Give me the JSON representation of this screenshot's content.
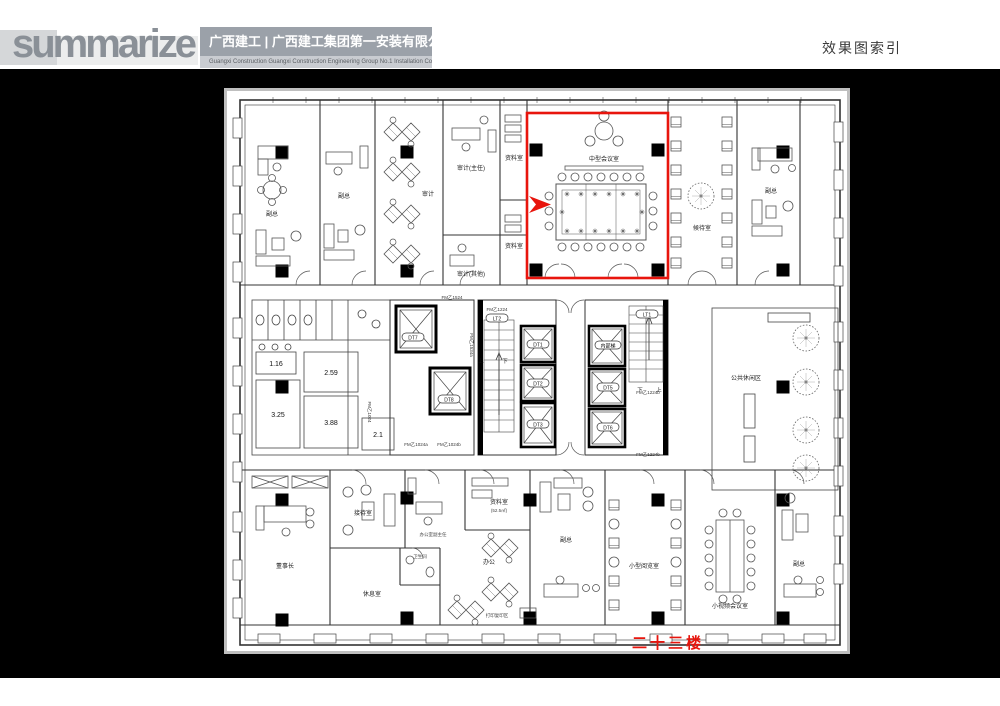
{
  "header": {
    "logo_text": "summarize",
    "company_name_cn": "广西建工 | 广西建工集团第一安装有限公司",
    "company_name_en": "Guangxi Construction      Guangxi Construction Engineering Group No.1 Installation Co.,Ltd",
    "page_title": "效果图索引"
  },
  "footer": {
    "floor_label": "二十三楼"
  },
  "colors": {
    "highlight_red": "#e8150d",
    "logo_gray": "#8a9097",
    "header_band_gray": "#9ba1a9",
    "drawing_line": "#333333"
  },
  "plan": {
    "highlighted_room": "中型会议室",
    "rooms": [
      {
        "label": "副总"
      },
      {
        "label": "副总"
      },
      {
        "label": "审计"
      },
      {
        "label": "审计(主任)"
      },
      {
        "label": "资料室"
      },
      {
        "label": "资料室"
      },
      {
        "label": "审计(其他)"
      },
      {
        "label": "中型会议室"
      },
      {
        "label": "候待室"
      },
      {
        "label": "副总"
      },
      {
        "label": "公共休闲区"
      },
      {
        "label": "董事长"
      },
      {
        "label": "接待室"
      },
      {
        "label": "休息室"
      },
      {
        "label": "卫生间"
      },
      {
        "label": "办公室副主任"
      },
      {
        "label": "资料室",
        "area": "(52.5㎡)"
      },
      {
        "label": "办公"
      },
      {
        "label": "打印复印区"
      },
      {
        "label": "副总"
      },
      {
        "label": "小型阅览室"
      },
      {
        "label": "小视频会议室"
      },
      {
        "label": "副总"
      }
    ],
    "elevators": [
      "DT7",
      "DT8",
      "LT2",
      "DT1",
      "DT2",
      "DT3",
      "内部梯",
      "DT5",
      "DT6",
      "LT1"
    ],
    "toilet_areas": [
      "1.16",
      "2.59",
      "3.25",
      "3.88",
      "2.1"
    ],
    "door_labels": [
      "FM乙1524",
      "FM乙1224",
      "FM乙1534a",
      "FM乙1024",
      "FM乙1024a",
      "FM乙1024b",
      "FM乙1224b",
      "FM乙1224b"
    ],
    "stair_marks": {
      "up": "上",
      "down": "下"
    }
  }
}
